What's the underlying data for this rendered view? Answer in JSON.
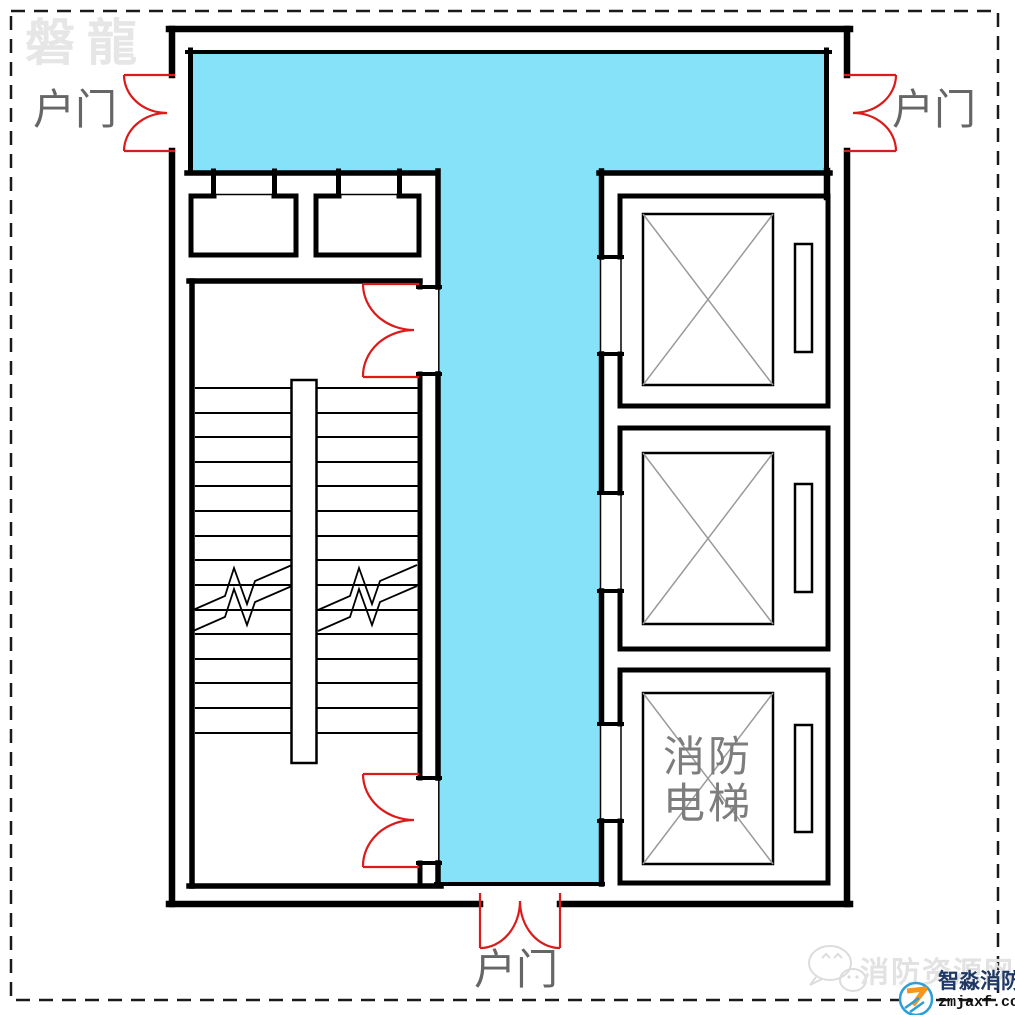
{
  "canvas": {
    "bg": "#ffffff",
    "border_color": "#1a1a1a"
  },
  "colors": {
    "corridor_fill": "#85e2f9",
    "door_swing": "#dc1a1a",
    "wall": "#000000",
    "label_text": "#666666",
    "fire_elevator_text": "#7d7d7d",
    "elevator_x": "#9a9a9a",
    "watermark_gray": "#e2e2e2",
    "logo_blue": "#2b9fd6",
    "logo_orange": "#f6971d",
    "logo_navy": "#1f3864"
  },
  "labels": {
    "entry_door_left": "户门",
    "entry_door_right": "户门",
    "entry_door_bottom": "户门",
    "fire_elevator_line1": "消防",
    "fire_elevator_line2": "电梯"
  },
  "watermarks": {
    "brand_top_left": "磐龍",
    "site_name": "消防资源网",
    "logo_name": "智淼消防",
    "logo_domain": "zmjaxf.com"
  }
}
